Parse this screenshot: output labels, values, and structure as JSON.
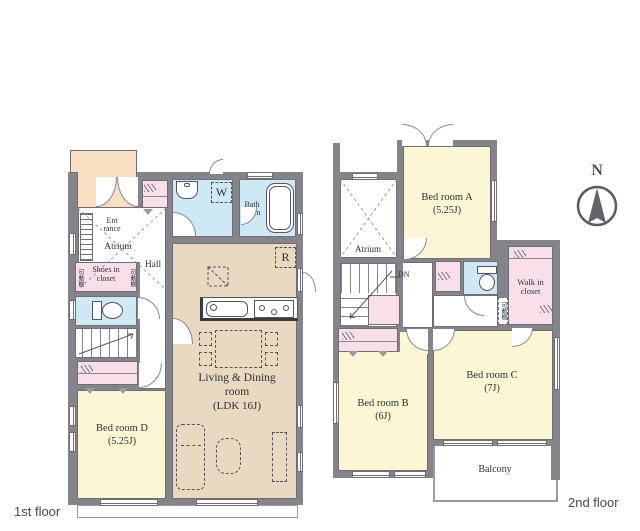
{
  "colors": {
    "wall": "#84848a",
    "yellow": "#fbf7d5",
    "tan": "#ead9c1",
    "blue": "#cfe8f5",
    "pink": "#f9dfea",
    "orange": "#f8dfc1",
    "text": "#2f2f3a"
  },
  "compass": {
    "label": "N"
  },
  "floor1": {
    "label": "1st floor",
    "entrance": {
      "l1": "Ent",
      "l2": "rance"
    },
    "atrium": "Atrium",
    "shoes_closet": {
      "l1": "Shoes in",
      "l2": "closet"
    },
    "shelf_left": "可動棚",
    "shelf_right": "可動棚",
    "hall": "Hall",
    "bath": {
      "l1": "Bath",
      "l2": "room"
    },
    "washer_label": "W",
    "fridge_label": "R",
    "living": {
      "l1": "Living & Dining",
      "l2": "room",
      "l3": "(LDK 16J)"
    },
    "bedroom_d": {
      "l1": "Bed room D",
      "l2": "(5.25J)"
    }
  },
  "floor2": {
    "label": "2nd floor",
    "atrium": "Atrium",
    "down_label": "DN",
    "bedroom_a": {
      "l1": "Bed room A",
      "l2": "(5.25J)"
    },
    "bedroom_b": {
      "l1": "Bed room B",
      "l2": "(6J)"
    },
    "bedroom_c": {
      "l1": "Bed room C",
      "l2": "(7J)"
    },
    "walkin": {
      "l1": "Walk in",
      "l2": "closet"
    },
    "shelf": "可動棚",
    "balcony": "Balcony"
  }
}
